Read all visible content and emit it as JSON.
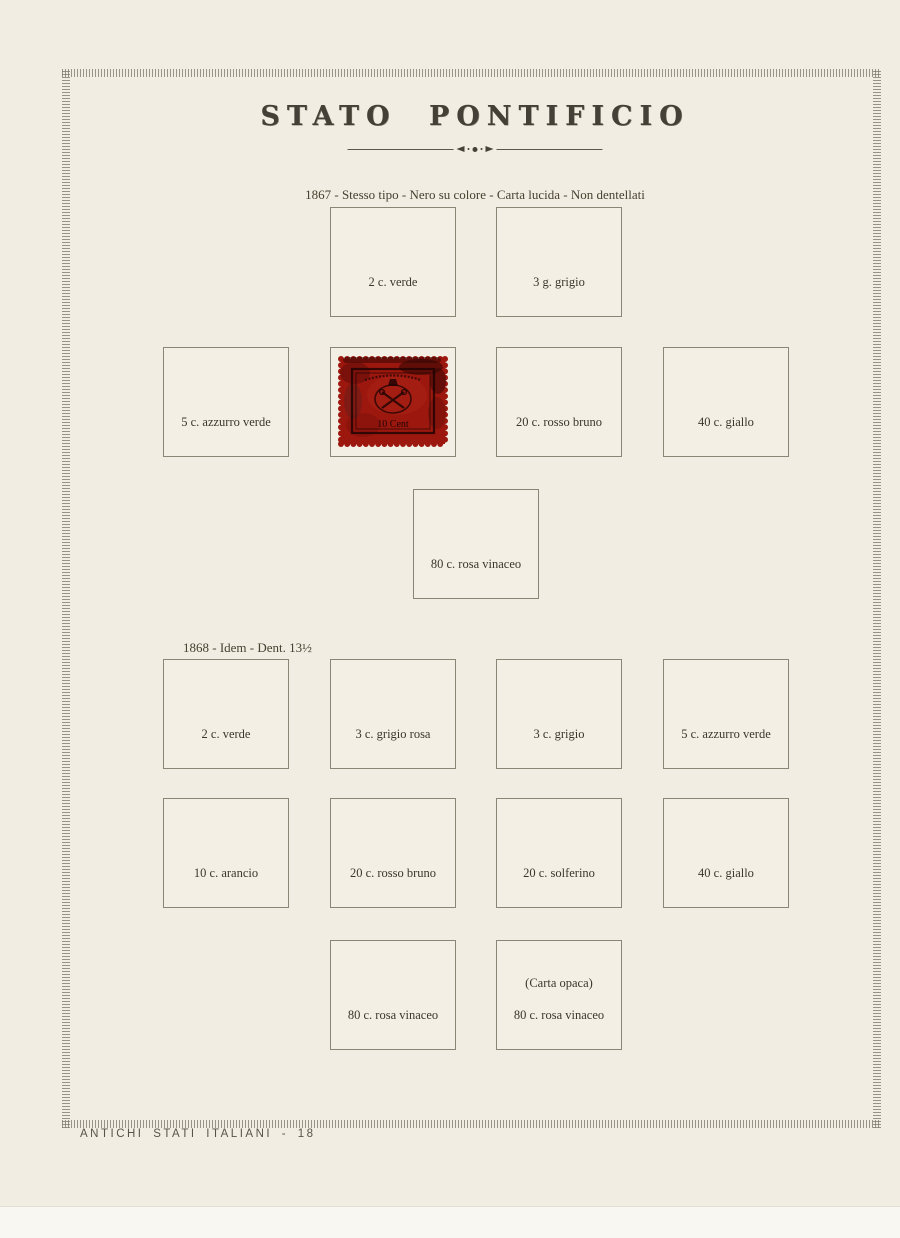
{
  "page": {
    "title": "STATO PONTIFICIO",
    "footer": "ANTICHI STATI ITALIANI - 18",
    "colors": {
      "paper": "#f1ede2",
      "stamp_red": "#9c170e",
      "ink": "#3c362d"
    }
  },
  "sections": [
    {
      "heading": "1867 - Stesso tipo - Nero su colore - Carta lucida - Non dentellati",
      "rows": [
        {
          "cells": [
            {
              "label": "2 c. verde"
            },
            {
              "label": "3 g. grigio"
            }
          ]
        },
        {
          "cells": [
            {
              "label": "5 c. azzurro verde"
            },
            {
              "stamp": true
            },
            {
              "label": "20 c. rosso bruno"
            },
            {
              "label": "40 c. giallo"
            }
          ]
        },
        {
          "cells": [
            {
              "label": "80 c. rosa vinaceo"
            }
          ]
        }
      ]
    },
    {
      "heading": "1868 - Idem - Dent. 13½",
      "rows": [
        {
          "cells": [
            {
              "label": "2 c. verde"
            },
            {
              "label": "3 c. grigio rosa"
            },
            {
              "label": "3 c. grigio"
            },
            {
              "label": "5 c. azzurro verde"
            }
          ]
        },
        {
          "cells": [
            {
              "label": "10 c. arancio"
            },
            {
              "label": "20 c. rosso bruno"
            },
            {
              "label": "20 c. solferino"
            },
            {
              "label": "40 c. giallo"
            }
          ]
        },
        {
          "cells": [
            {
              "label": "80 c. rosa vinaceo"
            },
            {
              "sublabel": "(Carta opaca)",
              "label": "80 c. rosa vinaceo"
            }
          ]
        }
      ]
    }
  ],
  "stamp": {
    "inscription": "10 Cent"
  }
}
